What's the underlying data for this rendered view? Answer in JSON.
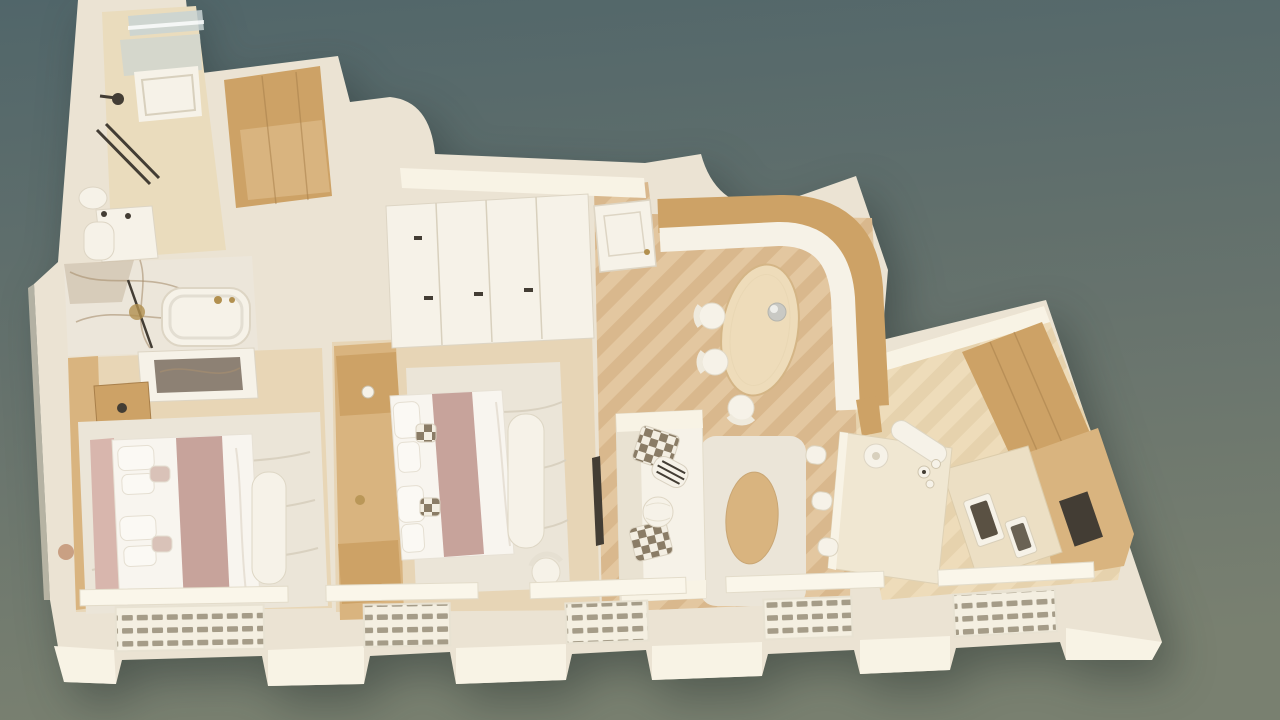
{
  "scene": {
    "description": "3D cutaway dollhouse floor-plan render of a cream-and-oak apartment viewed from above on a sage green background",
    "render_style": "top-down architectural visualization, no visible text",
    "rooms": [
      {
        "id": "bathroom-shower",
        "label": "Shower bathroom",
        "items": [
          "walk-in shower",
          "glass screen",
          "shower tray",
          "rain shower head",
          "vanity basin",
          "towel rails"
        ]
      },
      {
        "id": "wardrobe-niche",
        "label": "Wood-lined closet niche",
        "items": [
          "oak interior"
        ]
      },
      {
        "id": "bathroom-marble",
        "label": "Marble bathroom",
        "items": [
          "freestanding bathtub",
          "gold fixtures",
          "slim floor lamp",
          "veined marble surfaces"
        ]
      },
      {
        "id": "bedroom-1",
        "label": "Bedroom 1",
        "items": [
          "double bed",
          "mauve throw band",
          "upholstered headboard",
          "oak nightstand",
          "wavy cream rug",
          "boucle bench",
          "marble-top dresser",
          "window radiator"
        ]
      },
      {
        "id": "bedroom-2",
        "label": "Bedroom 2",
        "items": [
          "double bed",
          "mauve runner",
          "oak headboard wall with nightstands",
          "checker accent pillows",
          "textured cream rug",
          "boucle bench",
          "desk chair",
          "wall TV",
          "window radiator"
        ]
      },
      {
        "id": "hallway",
        "label": "Entry hallway",
        "items": [
          "white entry door with gold knob",
          "built-in wardrobes with handles"
        ]
      },
      {
        "id": "dining",
        "label": "Dining nook",
        "items": [
          "curved oak banquette back",
          "white banquette seat",
          "oval oak table",
          "two round chairs",
          "side chair",
          "grey pendant lamp"
        ]
      },
      {
        "id": "living",
        "label": "Living room",
        "items": [
          "cream sofa",
          "two checkerboard cushions",
          "striped cushion",
          "boucle ball cushion",
          "cream rug",
          "oval oak coffee table",
          "window radiator"
        ]
      },
      {
        "id": "kitchen",
        "label": "Kitchen / study",
        "items": [
          "stone island",
          "three cream stools",
          "white table lamp",
          "curved white bench",
          "stacked oak tall units",
          "oak cabinet block",
          "travertine counter with appliances",
          "plate set",
          "window radiator"
        ]
      }
    ],
    "window_bays": 5,
    "radiators_per_bay": 1
  },
  "colors": {
    "bg_top": "#51666a",
    "bg_mid": "#67736d",
    "bg_bottom": "#798070",
    "wall": "#ebe3d3",
    "wall_bright": "#f8f3e5",
    "wall_shade": "#d8d0bd",
    "floor_a": "#d9b88d",
    "floor_b": "#e3c7a0",
    "floor_c": "#e6d2ad",
    "floor_d": "#eedcba",
    "floor_bed1": "#e8d6b6",
    "tile": "#eadcbd",
    "marble": "#ece6da",
    "marble_vein": "#a8906f",
    "wood": "#cda266",
    "wood_light": "#d9b47f",
    "wood_dark": "#a87f4a",
    "stone": "#f0e7d2",
    "soft_white": "#f6f2e8",
    "bed_white": "#f8f5ef",
    "rug": "#ebe5d8",
    "rug_line": "#d9d1c0",
    "mauve": "#c7a39b",
    "mauve_light": "#d8b6ad",
    "pillow_dark": "#8a7c66",
    "pillow_light": "#f3eee2",
    "dark": "#433d34",
    "gold": "#b2904f",
    "glass": "#c9d4d4",
    "rad_slot": "#a59c88"
  }
}
